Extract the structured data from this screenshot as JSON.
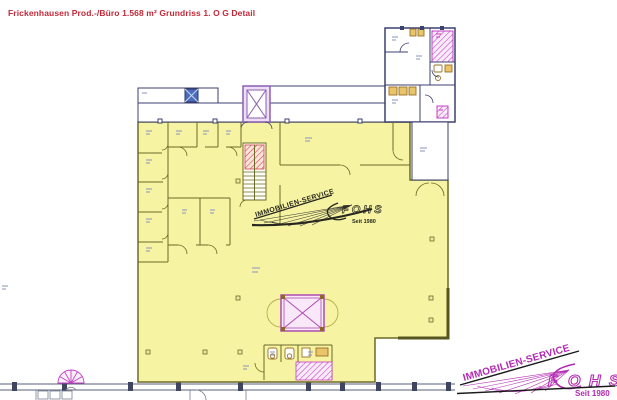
{
  "title": {
    "text": "Frickenhausen Prod.-/Büro 1.568 m² Grundriss 1. O G Detail",
    "color": "#c32839"
  },
  "plan": {
    "colors": {
      "area_fill": "#f6f3a2",
      "wall_olive": "#6b6b28",
      "wall_navy": "#3b4170",
      "magenta": "#c43fc4",
      "purple_elevator": "#8b5fb5",
      "red_stair_hatch": "#cc4545",
      "fixture_brown": "#9a7228",
      "lift_symbol_blue": "#4a6cc0"
    }
  },
  "watermark": {
    "service": "IMMOBILIEN-SERVICE",
    "brand": "FOHS",
    "tagline": "Seit 1980"
  },
  "logo": {
    "service": "IMMOBILIEN-SERVICE",
    "letters": [
      "F",
      "O",
      "H",
      "S"
    ],
    "tagline": "Seit 1980",
    "color": "#b32bb3"
  }
}
